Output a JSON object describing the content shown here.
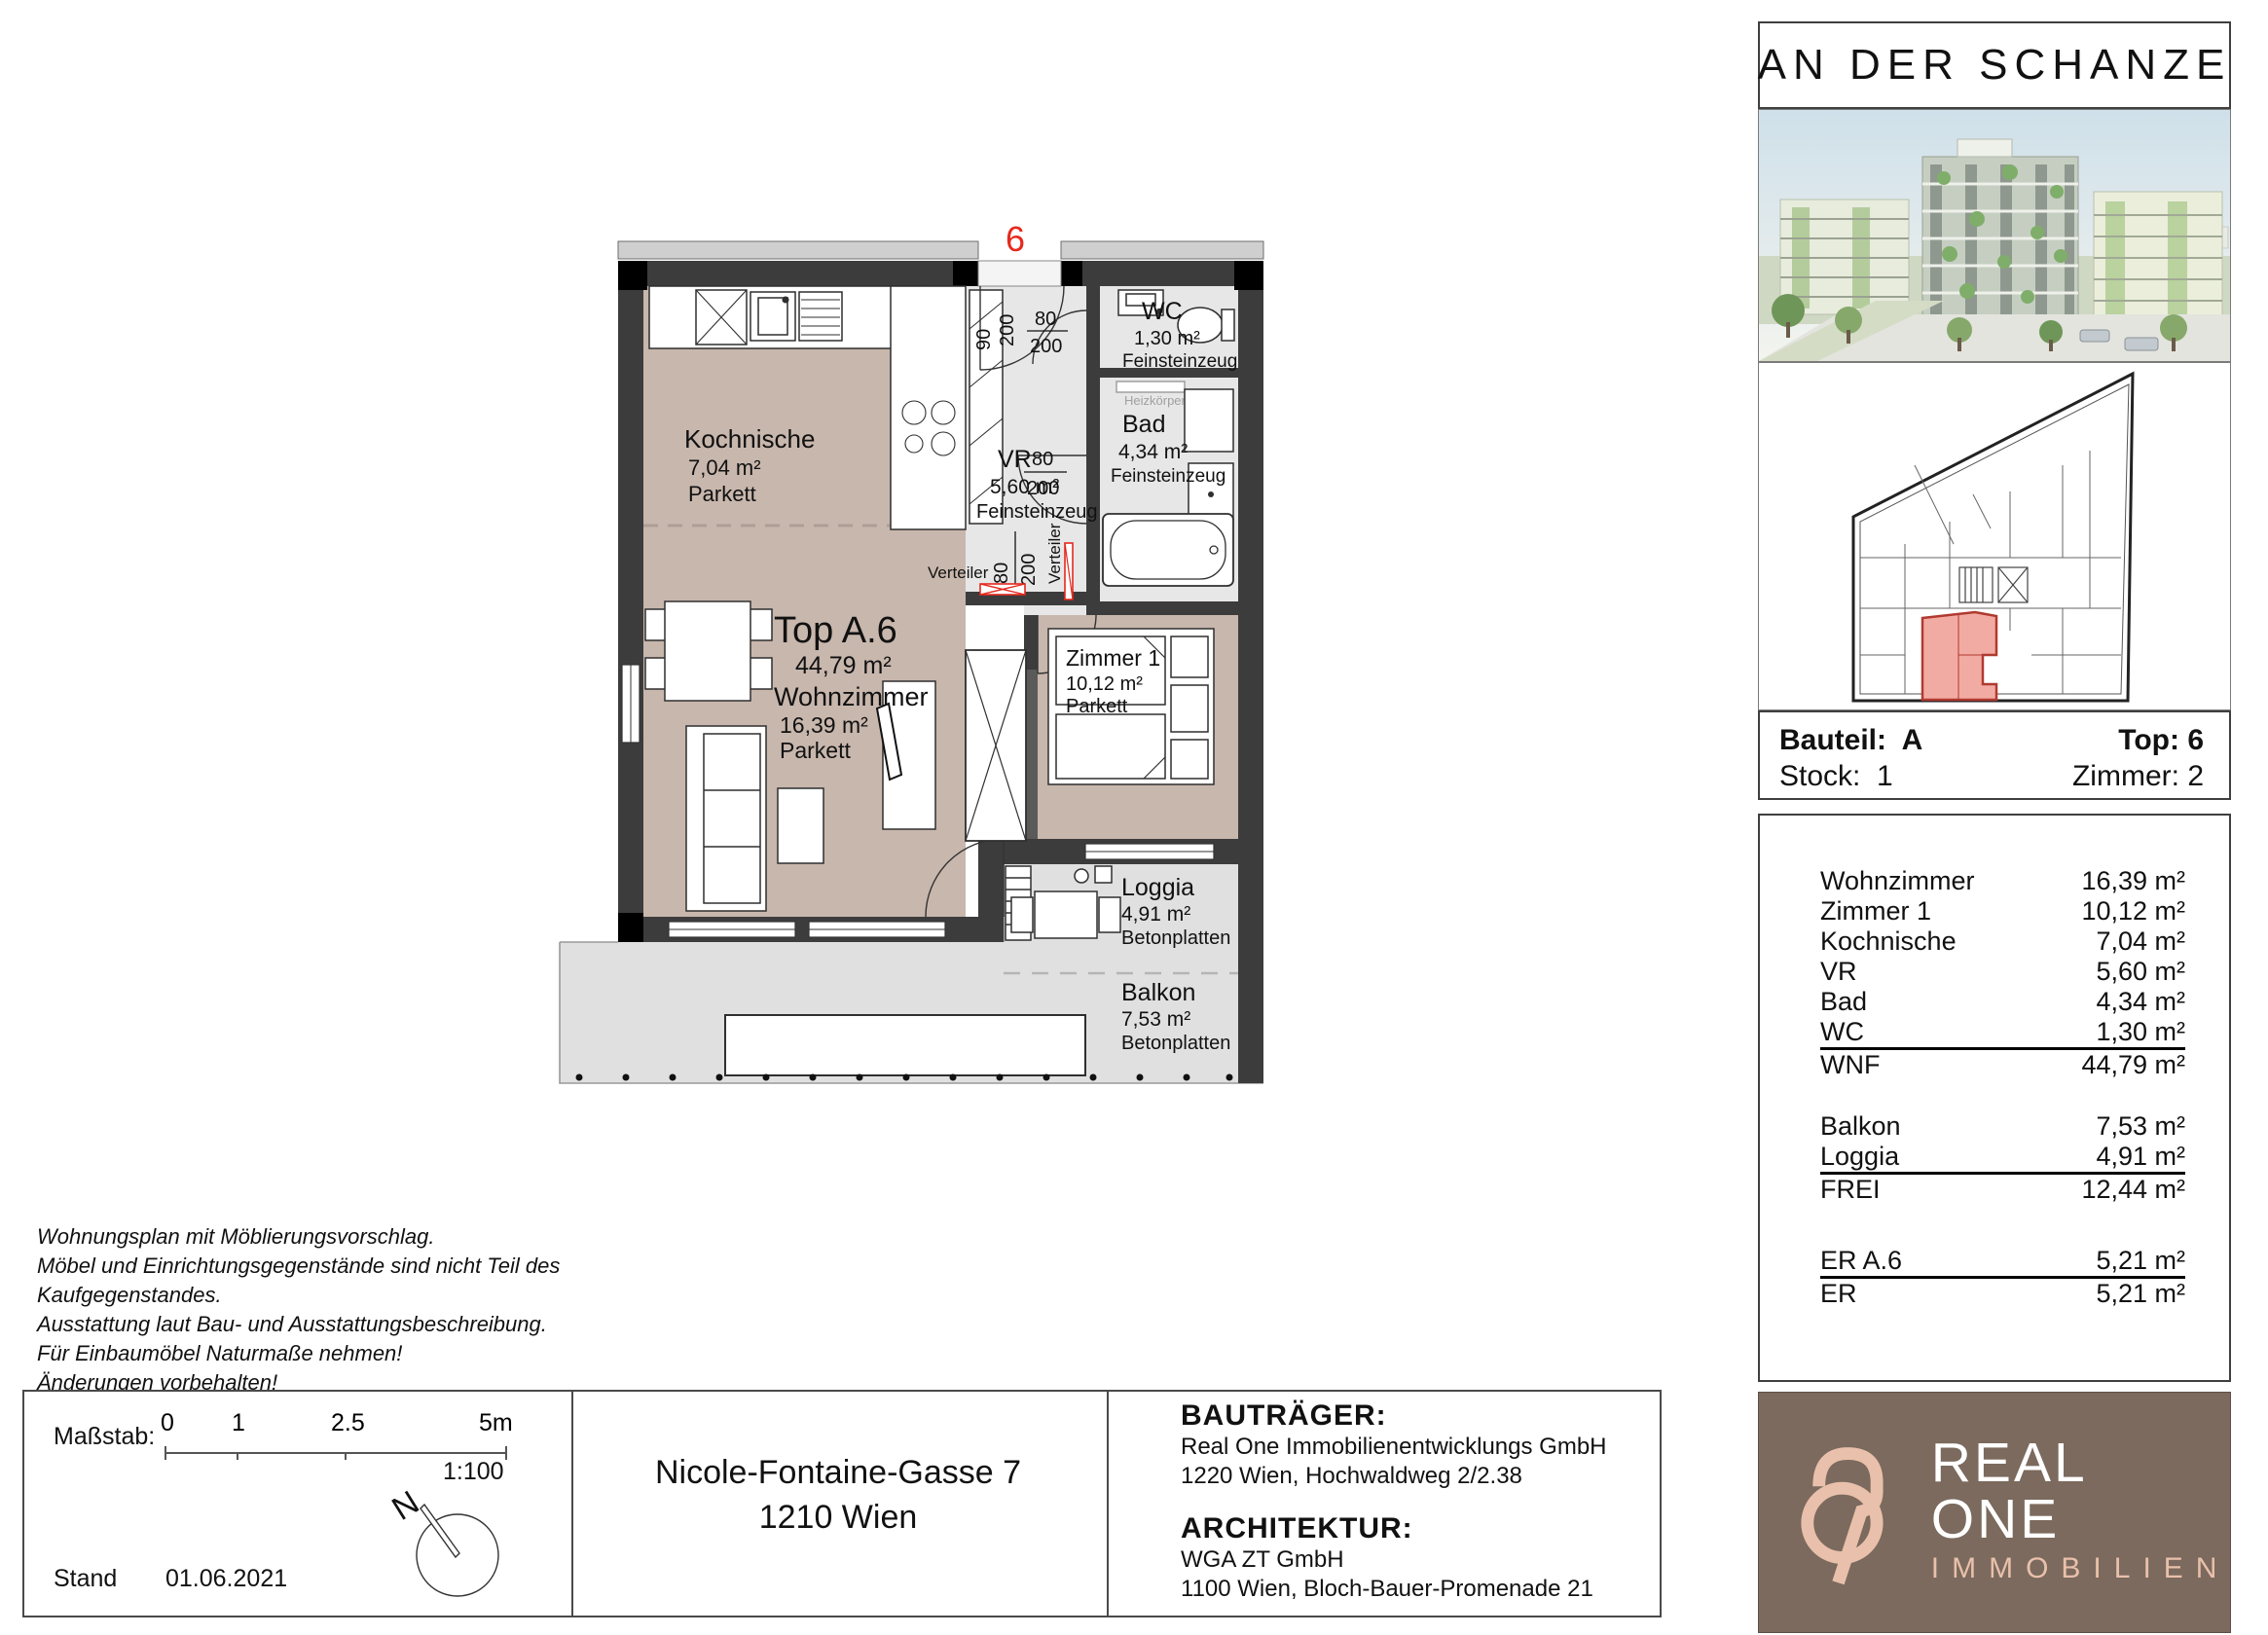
{
  "project": {
    "title": "AN DER SCHANZE"
  },
  "unit_info": {
    "bauteil_label": "Bauteil:",
    "bauteil_value": "A",
    "top_label": "Top:",
    "top_value": "6",
    "stock_label": "Stock:",
    "stock_value": "1",
    "zimmer_label": "Zimmer:",
    "zimmer_value": "2"
  },
  "area_table": {
    "rows": [
      {
        "name": "Wohnzimmer",
        "area": "16,39 m²"
      },
      {
        "name": "Zimmer 1",
        "area": "10,12 m²"
      },
      {
        "name": "Kochnische",
        "area": "7,04 m²"
      },
      {
        "name": "VR",
        "area": "5,60 m²"
      },
      {
        "name": "Bad",
        "area": "4,34 m²"
      },
      {
        "name": "WC",
        "area": "1,30 m²"
      },
      {
        "name": "WNF",
        "area": "44,79 m²"
      },
      {
        "name": "Balkon",
        "area": "7,53 m²"
      },
      {
        "name": "Loggia",
        "area": "4,91 m²"
      },
      {
        "name": "FREI",
        "area": "12,44 m²"
      },
      {
        "name": "ER A.6",
        "area": "5,21 m²"
      },
      {
        "name": "ER",
        "area": "5,21 m²"
      }
    ]
  },
  "floor_plan": {
    "unit_marker": "6",
    "rooms": [
      {
        "name": "Kochnische",
        "area": "7,04 m²",
        "floor": "Parkett"
      },
      {
        "name": "Top A.6",
        "area": "44,79 m²",
        "floor": ""
      },
      {
        "name": "Wohnzimmer",
        "area": "16,39 m²",
        "floor": "Parkett"
      },
      {
        "name": "Zimmer 1",
        "area": "10,12 m²",
        "floor": "Parkett"
      },
      {
        "name": "VR",
        "area": "5,60 m²",
        "floor": "Feinsteinzeug"
      },
      {
        "name": "WC",
        "area": "1,30 m²",
        "floor": "Feinsteinzeug"
      },
      {
        "name": "Bad",
        "area": "4,34 m²",
        "floor": "Feinsteinzeug"
      },
      {
        "name": "Loggia",
        "area": "4,91 m²",
        "floor": "Betonplatten"
      },
      {
        "name": "Balkon",
        "area": "7,53 m²",
        "floor": "Betonplatten"
      }
    ],
    "annotations": {
      "verteiler": "Verteiler",
      "heizkoerper": "Heizkörper",
      "dims": [
        "90",
        "200",
        "80",
        "200",
        "80",
        "200",
        "80",
        "200"
      ]
    }
  },
  "disclaimer": {
    "lines": [
      "Wohnungsplan mit Möblierungsvorschlag.",
      "Möbel und Einrichtungsgegenstände sind nicht Teil des",
      "Kaufgegenstandes.",
      "Ausstattung laut Bau- und Ausstattungsbeschreibung.",
      "Für Einbaumöbel Naturmaße nehmen!",
      "Änderungen vorbehalten!"
    ]
  },
  "scale_box": {
    "label": "Maßstab:",
    "tick_labels": [
      "0",
      "1",
      "2.5",
      "5m"
    ],
    "ratio": "1:100",
    "stand_label": "Stand",
    "stand_date": "01.06.2021",
    "north_label": "N"
  },
  "address": {
    "line1": "Nicole-Fontaine-Gasse 7",
    "line2": "1210 Wien"
  },
  "developer": {
    "heading": "BAUTRÄGER:",
    "name": "Real One Immobilienentwicklungs GmbH",
    "address": "1220 Wien, Hochwaldweg 2/2.38"
  },
  "architect": {
    "heading": "ARCHITEKTUR:",
    "name": "WGA ZT GmbH",
    "address": "1100 Wien, Bloch-Bauer-Promenade 21"
  },
  "logo": {
    "brand": "REAL ONE",
    "sub": "IMMOBILIEN"
  },
  "colors": {
    "accent_red": "#e5291d",
    "floor_brown": "#c8b7ad",
    "floor_gray": "#e7e7e7",
    "terrace_gray": "#e0e0e0",
    "wall_dark": "#3c3c3c",
    "logo_bg": "#7b6a5d",
    "logo_beige": "#e9c0ab",
    "unit_highlight": "#f2aba3"
  }
}
